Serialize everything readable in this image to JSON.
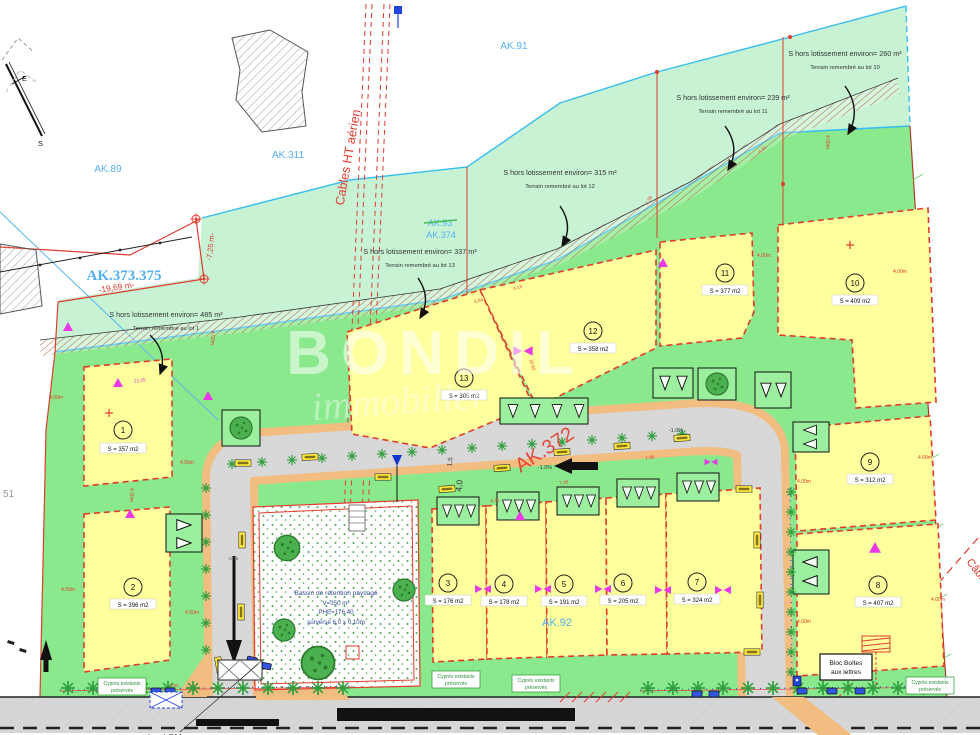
{
  "plan": {
    "watermark": {
      "name": "BONDIL",
      "tagline": "immobilier"
    },
    "parcels": {
      "ak89": "AK.89",
      "ak91": "AK.91",
      "ak311": "AK.311",
      "ak373_375": "AK.373.375",
      "ak93_struck": "AK.93",
      "ak374": "AK.374",
      "ak92": "AK.92",
      "left_parcel": "51"
    },
    "road_name": "AK.372",
    "cables_ht": "Cables HT aérien",
    "cables_right": "Câbles",
    "hors_lots": [
      {
        "surface": "S hors lotissement environ= 260 m²",
        "note": "Terrain remembré au lot 10"
      },
      {
        "surface": "S hors lotissement environ= 239 m²",
        "note": "Terrain remembré au lot 11"
      },
      {
        "surface": "S hors lotissement environ= 315 m²",
        "note": "Terrain remembré au lot 12"
      },
      {
        "surface": "S hors lotissement environ= 337 m²",
        "note": "Terrain remembré au lot 13"
      },
      {
        "surface": "S hors lotissement environ= 485 m²",
        "note": "Terrain remembré au lot 1"
      }
    ],
    "lots": [
      {
        "num": "1",
        "area": "S = 357 m2"
      },
      {
        "num": "2",
        "area": "S = 396 m2"
      },
      {
        "num": "3",
        "area": "S = 176 m2"
      },
      {
        "num": "4",
        "area": "S = 178 m2"
      },
      {
        "num": "5",
        "area": "S = 191 m2"
      },
      {
        "num": "6",
        "area": "S = 205 m2"
      },
      {
        "num": "7",
        "area": "S = 324 m2"
      },
      {
        "num": "8",
        "area": "S = 407 m2"
      },
      {
        "num": "9",
        "area": "S = 312 m2"
      },
      {
        "num": "10",
        "area": "S = 409 m2"
      },
      {
        "num": "11",
        "area": "S = 377 m2"
      },
      {
        "num": "12",
        "area": "S = 358 m2"
      },
      {
        "num": "13",
        "area": "S = 305 m2"
      }
    ],
    "basin": {
      "line1": "Bassin de rétention paysagé",
      "line2": "V=350 m³",
      "line3": "PHE=176.40",
      "line4": "surverse 6,0 x 0,10m"
    },
    "boxes": {
      "mailbox_line1": "Bloc Boîtes",
      "mailbox_line2": "aux lettres",
      "cypress_line1": "Cyprès existants",
      "cypress_line2": "préservés"
    },
    "street_note": "local OM",
    "compass": {
      "east": "E",
      "south": "S"
    },
    "dims": {
      "d400": "4.00m",
      "w1969": "-19,69 m-",
      "w725": "-7,25 m-",
      "road_w": "4,0",
      "walk_w": "1,5",
      "slope": "-1.0%"
    },
    "edge_measures": {
      "m2125": "21.25",
      "m470": "4.70",
      "m238": "2.38",
      "m413": "4.13",
      "m504": "5.04",
      "m730": "7.30",
      "m475": "4.75",
      "m198": "1.98",
      "m493": "4.93",
      "m205": "-2.05",
      "m1693": "16.93"
    },
    "colors": {
      "pale_green": "#c7f2d4",
      "green": "#8ae98c",
      "lot_yellow": "#feff9d",
      "road_gray": "#d8d8d8",
      "sidewalk_tan": "#f2bd80",
      "line_red": "#e23b2e",
      "label_blue": "#55b0f0",
      "stream_blue": "#38bdf0",
      "magenta": "#e838e8",
      "hedge_green": "#2f9e3d"
    }
  }
}
